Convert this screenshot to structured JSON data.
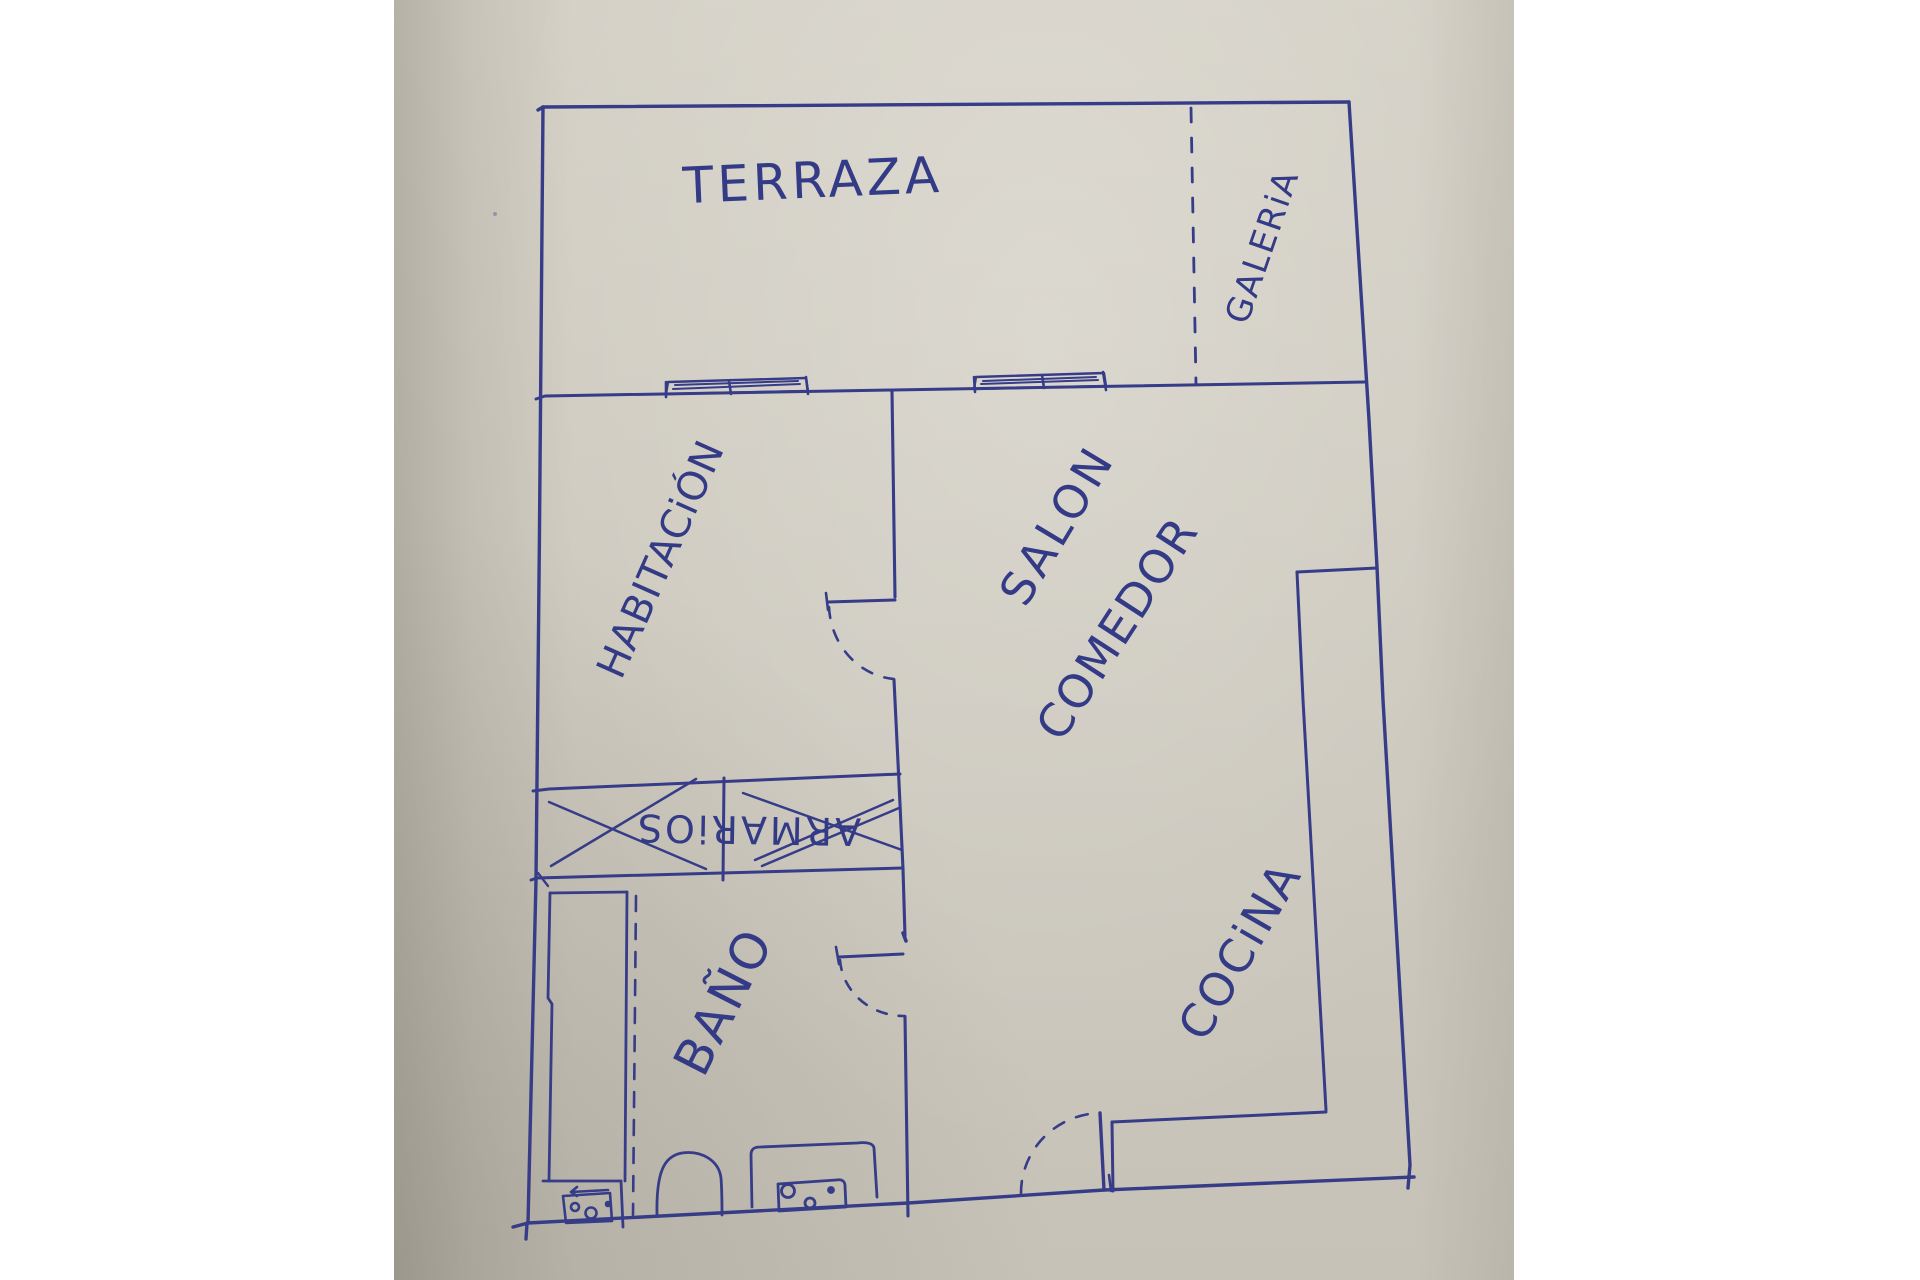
{
  "palette": {
    "background": "#ffffff",
    "paper": "#d2cec3",
    "paper_shadow": "#b7b3a8",
    "ink": "#363c88"
  },
  "plan": {
    "rooms": {
      "terraza": {
        "label": "TERRAZA"
      },
      "galeria": {
        "label": "GALERiA"
      },
      "habitacion": {
        "label": "HABITACiÓN"
      },
      "salon_comedor": {
        "label_line1": "SALON",
        "label_line2": "COMEDOR"
      },
      "armarios": {
        "label": "ARMARiOS",
        "status": "crossed out with X marks"
      },
      "bano": {
        "label": "BAÑO"
      },
      "cocina": {
        "label": "COCiNA"
      }
    },
    "symbols": {
      "windows": [
        "terraza-window-left",
        "terraza-window-right"
      ],
      "doors": [
        "habitacion-door-swing",
        "bano-door-swing",
        "entrance-door-swing"
      ],
      "fixtures": [
        "bathtub",
        "toilet",
        "sink-vanity",
        "small-cabinet"
      ],
      "kitchen": "l-shaped-counter",
      "partition": "galeria-dashed-line"
    }
  }
}
